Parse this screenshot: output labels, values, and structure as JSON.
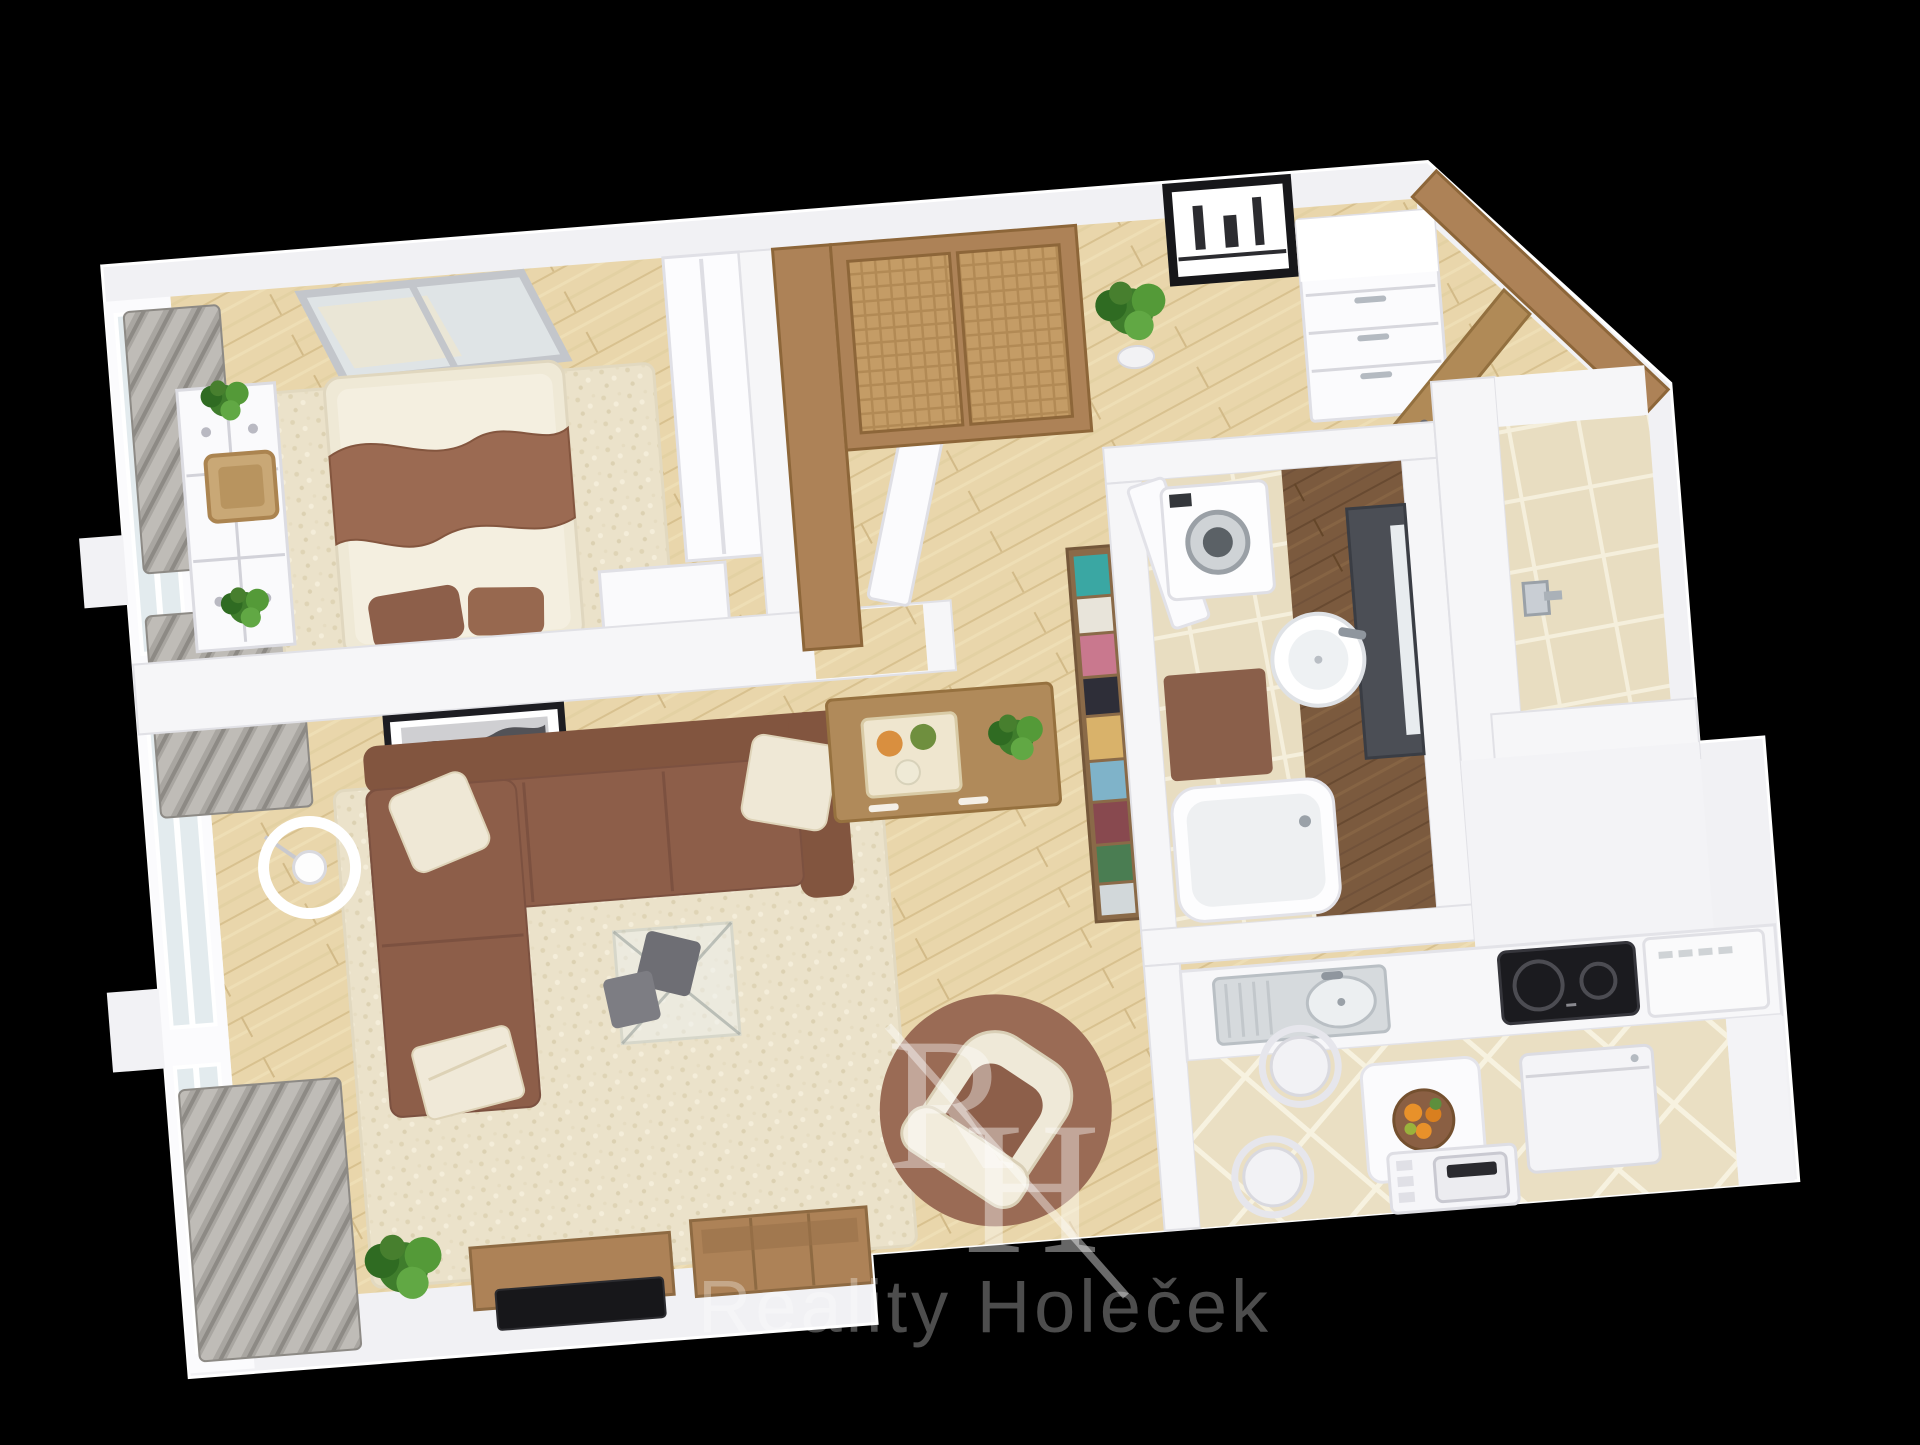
{
  "scene": {
    "type": "3d-floorplan-top-view-render",
    "background_color": "#000000",
    "plan_rotation_deg": -4.5,
    "apartment_layout": "1-bedroom apartment with living room, hallway, bathroom, wc and kitchen"
  },
  "watermark": {
    "monogram_r": "R",
    "monogram_h": "H",
    "company": "Reality Holeček",
    "color": "#ffffff"
  },
  "palette": {
    "background": "#000000",
    "wall_white": "#f2f2f5",
    "floor_wood_light": "#e9d6ab",
    "floor_wood_dark": "#7b5a3e",
    "tile_beige": "#eadfc3",
    "rug_cream": "#ebe2ca",
    "sofa_brown": "#8d5e49",
    "accent_brown": "#9a6b55",
    "furniture_wood": "#ad8257",
    "curtain_gray": "#a9a6a1",
    "glass_blue": "#e3ebee",
    "plant_green": "#4e8f3a",
    "tv_black": "#17171a"
  },
  "rooms": [
    {
      "name": "bedroom",
      "floor": "light-wood with cream shag rug",
      "furniture": [
        "double-bed",
        "brown-wave-throw",
        "brown-pillows",
        "wall-mirror-two-panel",
        "white-dresser",
        "wicker-basket",
        "potted-plant",
        "potted-plant",
        "white-bedside-bench",
        "built-in-white-wardrobe",
        "gray-curtains",
        "window-band"
      ]
    },
    {
      "name": "living-room",
      "floor": "light-wood with cream shag rug",
      "furniture": [
        "brown-corner-sofa",
        "cream-cushions",
        "folded-blanket",
        "glass-coffee-table",
        "gray-seat-cushions",
        "drum-floor-lamp",
        "framed-picture",
        "round-brown-rug",
        "cream-armchair",
        "tv-lowboard",
        "flat-tv",
        "wooden-storage-box",
        "potted-plant",
        "gray-curtains",
        "window-band"
      ]
    },
    {
      "name": "hallway",
      "floor": "light-wood",
      "furniture": [
        "sliding-door-wardrobe",
        "potted-plant",
        "framed-picture",
        "white-chest-of-drawers",
        "entrance-door-open",
        "white-interior-door",
        "wooden-console",
        "candle-tray",
        "bookshelf-with-books"
      ]
    },
    {
      "name": "bathroom",
      "floor": "beige-tile and dark-wood",
      "furniture": [
        "washing-machine",
        "round-basin-sink",
        "dark-vanity-with-mirror",
        "bathtub",
        "brown-bath-mat",
        "white-door"
      ]
    },
    {
      "name": "wc",
      "floor": "beige-tile",
      "furniture": [
        "toilet-paper-holder"
      ]
    },
    {
      "name": "kitchen",
      "floor": "beige-diamond-tile",
      "furniture": [
        "white-counter-run",
        "stainless-sink-with-drainer",
        "black-cooktop",
        "cooker-hood",
        "white-dining-table",
        "fruit-bowl",
        "white-chair",
        "white-chair",
        "white-appliance-cabinet",
        "toaster-on-stand"
      ]
    }
  ]
}
